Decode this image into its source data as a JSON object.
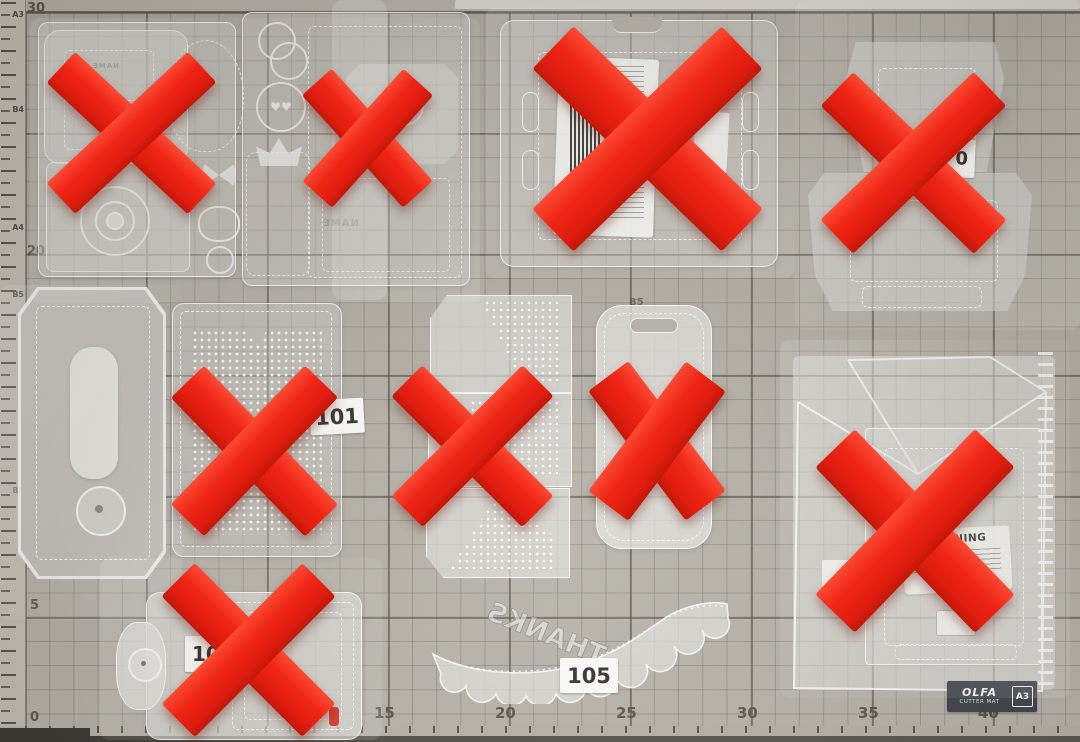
{
  "ruler": {
    "paper_sizes": [
      "A3",
      "B4",
      "A4",
      "B5",
      "B5"
    ]
  },
  "mat": {
    "left_scale": [
      "30",
      "20",
      "15",
      "10",
      "5",
      "0"
    ],
    "bottom_scale": [
      "15",
      "20",
      "25",
      "30",
      "35",
      "40"
    ],
    "grid_label": "B5",
    "badge": {
      "brand": "OLFA",
      "product": "CUTTER MAT",
      "size": "A3"
    }
  },
  "stickers": {
    "die6": "101",
    "die11": "105",
    "die10": "10",
    "die4": "0"
  },
  "die_engravings": {
    "thanks": "THANKS",
    "name_small": "NAME",
    "name_large": "NAME",
    "warning": "WARNING",
    "hearts": "♥♥"
  },
  "colors": {
    "x_red": "#ee2214",
    "mat_bg": "#b1ada4",
    "die_fill": "#d6d5d0",
    "badge_bg": "#3a3f48"
  }
}
